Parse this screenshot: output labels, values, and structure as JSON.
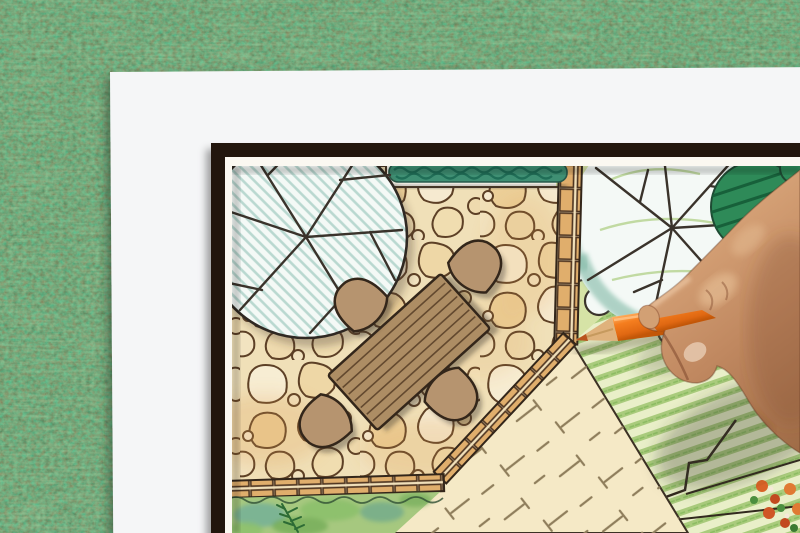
{
  "scene": {
    "description": "Top-down photo of a hand holding an orange colored pencil, drawing a landscape architecture garden plan on white paper lying on green grass",
    "elements": {
      "background": "artificial grass lawn",
      "paper": "white drawing paper sheet",
      "board": "dark framed garden plan drawing",
      "patio_tree": "large round tree symbol with teal hatching over patio",
      "hedge": "dark green hedge strip at top",
      "patio": "flagstone paved patio",
      "table": "wooden plank dining table, plan view",
      "chairs": "four rounded patio chairs",
      "wood_path": "brick edged walkway between patio and lawn",
      "lawn_tree": "scallop-outlined deciduous tree over lawn",
      "bush": "dark green hatched shrub",
      "lawn": "green striped lawn hatching",
      "ground_cover": "cream lawn area with cross-dash symbols",
      "planting_bed": "green watercolor planting bed with fern",
      "flower_bed": "flower cluster in bottom right corner",
      "hand": "right hand holding pencil",
      "pencil": "orange colored pencil with sharpened tip"
    }
  },
  "colors": {
    "grass_base": "#4c7c43",
    "paper": "#f5f6f7",
    "frame": "#241811",
    "plan_paper": "#fbf8f1",
    "stone_bg": "#f0e0b8",
    "stone_line": "#5d4026",
    "brick": "#e0ae6c",
    "hedge": "#3f8f73",
    "hedge_dark": "#1d6b54",
    "tree_fill": "#f4f9f6",
    "tree_hatch": "#b9d8d0",
    "branch": "#3a332b",
    "lawn_base": "#d6e3a6",
    "stripe_bg": "#e9efc8",
    "stripe_green": "#a9cb7c",
    "cream": "#f5e9c6",
    "dash": "#8f7e5c",
    "bed_green": "#a6c87f",
    "bush": "#2e8a58",
    "teal": "#74b29e",
    "table_wood": "#ad8d64",
    "chair_wood": "#b6946f",
    "outline": "#33261a",
    "pencil_orange": "#f57e1f",
    "pencil_hi": "#ffb266",
    "pencil_wood": "#dfb27c",
    "pencil_lead": "#b9541e",
    "skin_hi": "#dba87c",
    "skin_mid": "#c08860",
    "skin_dark": "#9d6a45",
    "flower_orange": "#d96327",
    "flower_red": "#c2491f",
    "leaf_green": "#4c8f3f"
  }
}
